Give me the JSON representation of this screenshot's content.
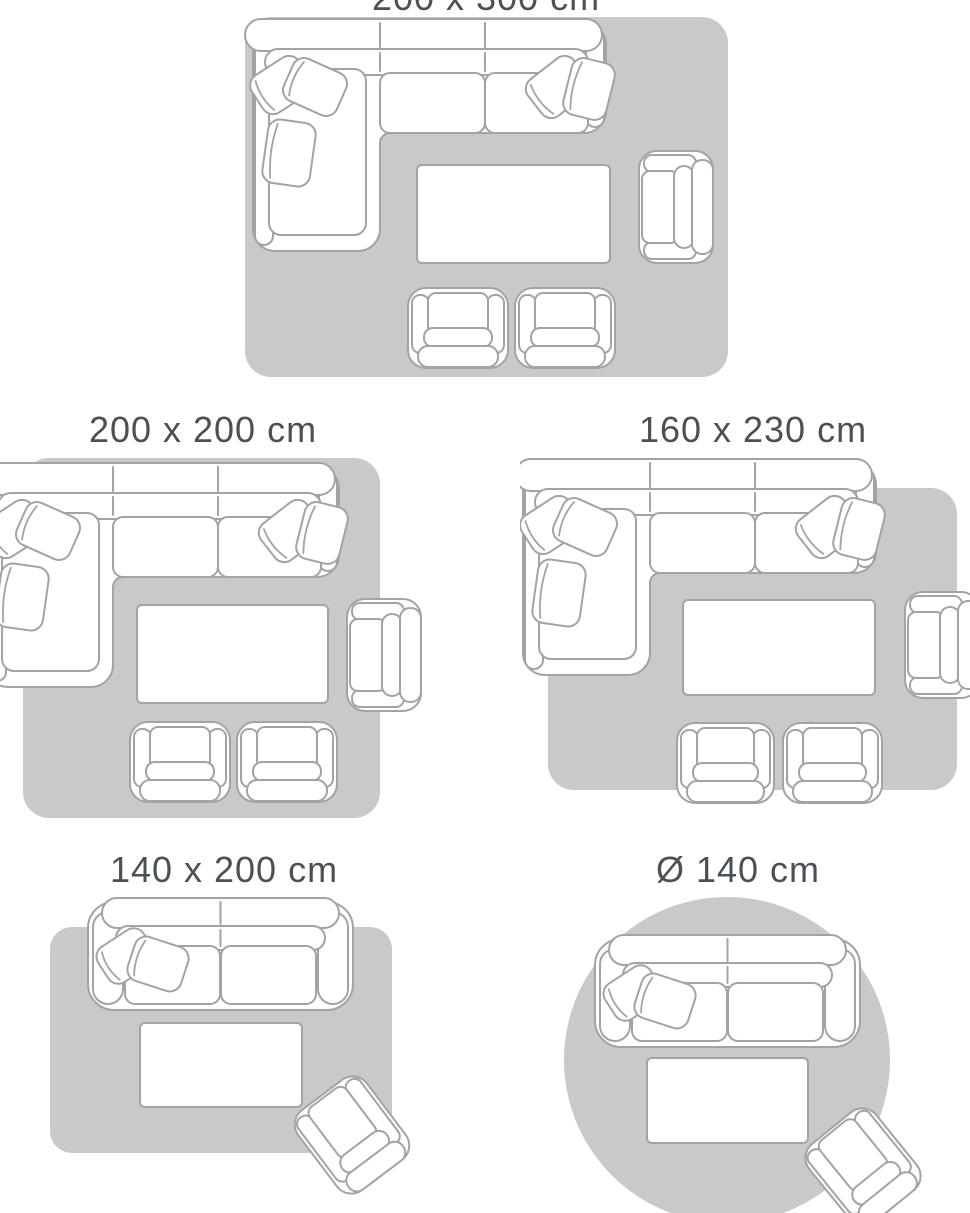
{
  "page": {
    "background": "#ffffff",
    "description": "Rug size guide with top-view living room layout diagrams"
  },
  "colors": {
    "rug": "#c9c9c9",
    "outline": "#a3a3a3",
    "furniture_fill": "#ffffff",
    "label_text": "#4b5055"
  },
  "diagrams": [
    {
      "id": "200x300",
      "label": "200 x 300 cm",
      "rug_shape": "rectangle",
      "layout": "corner-sofa, coffee table, armchair, two chairs",
      "note": "label cropped at top edge of image"
    },
    {
      "id": "200x200",
      "label": "200 x 200 cm",
      "rug_shape": "square",
      "layout": "corner-sofa (clipped at left edge), coffee table, armchair, two chairs"
    },
    {
      "id": "160x230",
      "label": "160 x 230 cm",
      "rug_shape": "rectangle",
      "layout": "corner-sofa, coffee table, armchair (clipped at right edge), two chairs"
    },
    {
      "id": "140x200",
      "label": "140 x 200 cm",
      "rug_shape": "rectangle",
      "layout": "two-seat sofa, coffee table, tilted armchair"
    },
    {
      "id": "d140",
      "label": "Ø 140 cm",
      "rug_shape": "circle",
      "layout": "two-seat sofa, coffee table, tilted armchair (clipped at bottom edge)"
    }
  ]
}
